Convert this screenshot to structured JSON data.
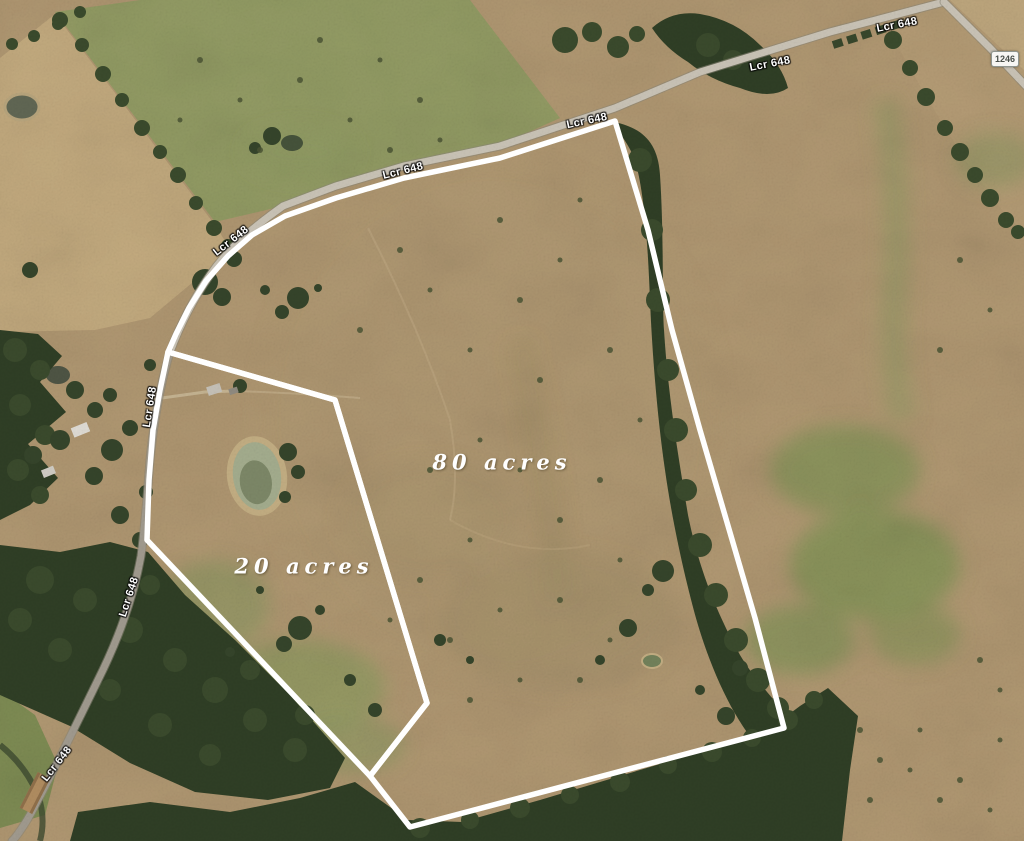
{
  "map": {
    "view": "aerial-satellite",
    "road_label": "Lcr 648",
    "road_label_instances": 8,
    "highway_badge_label": "1246",
    "parcels": [
      {
        "id": "parcel-80",
        "label": "80 acres"
      },
      {
        "id": "parcel-20",
        "label": "20 acres"
      }
    ],
    "colors": {
      "boundary": "#ffffff",
      "field_tan": "#b19872",
      "pasture_green": "#8a9659",
      "forest_green": "#2f3e25",
      "road_gray": "#c9c3b6"
    }
  }
}
